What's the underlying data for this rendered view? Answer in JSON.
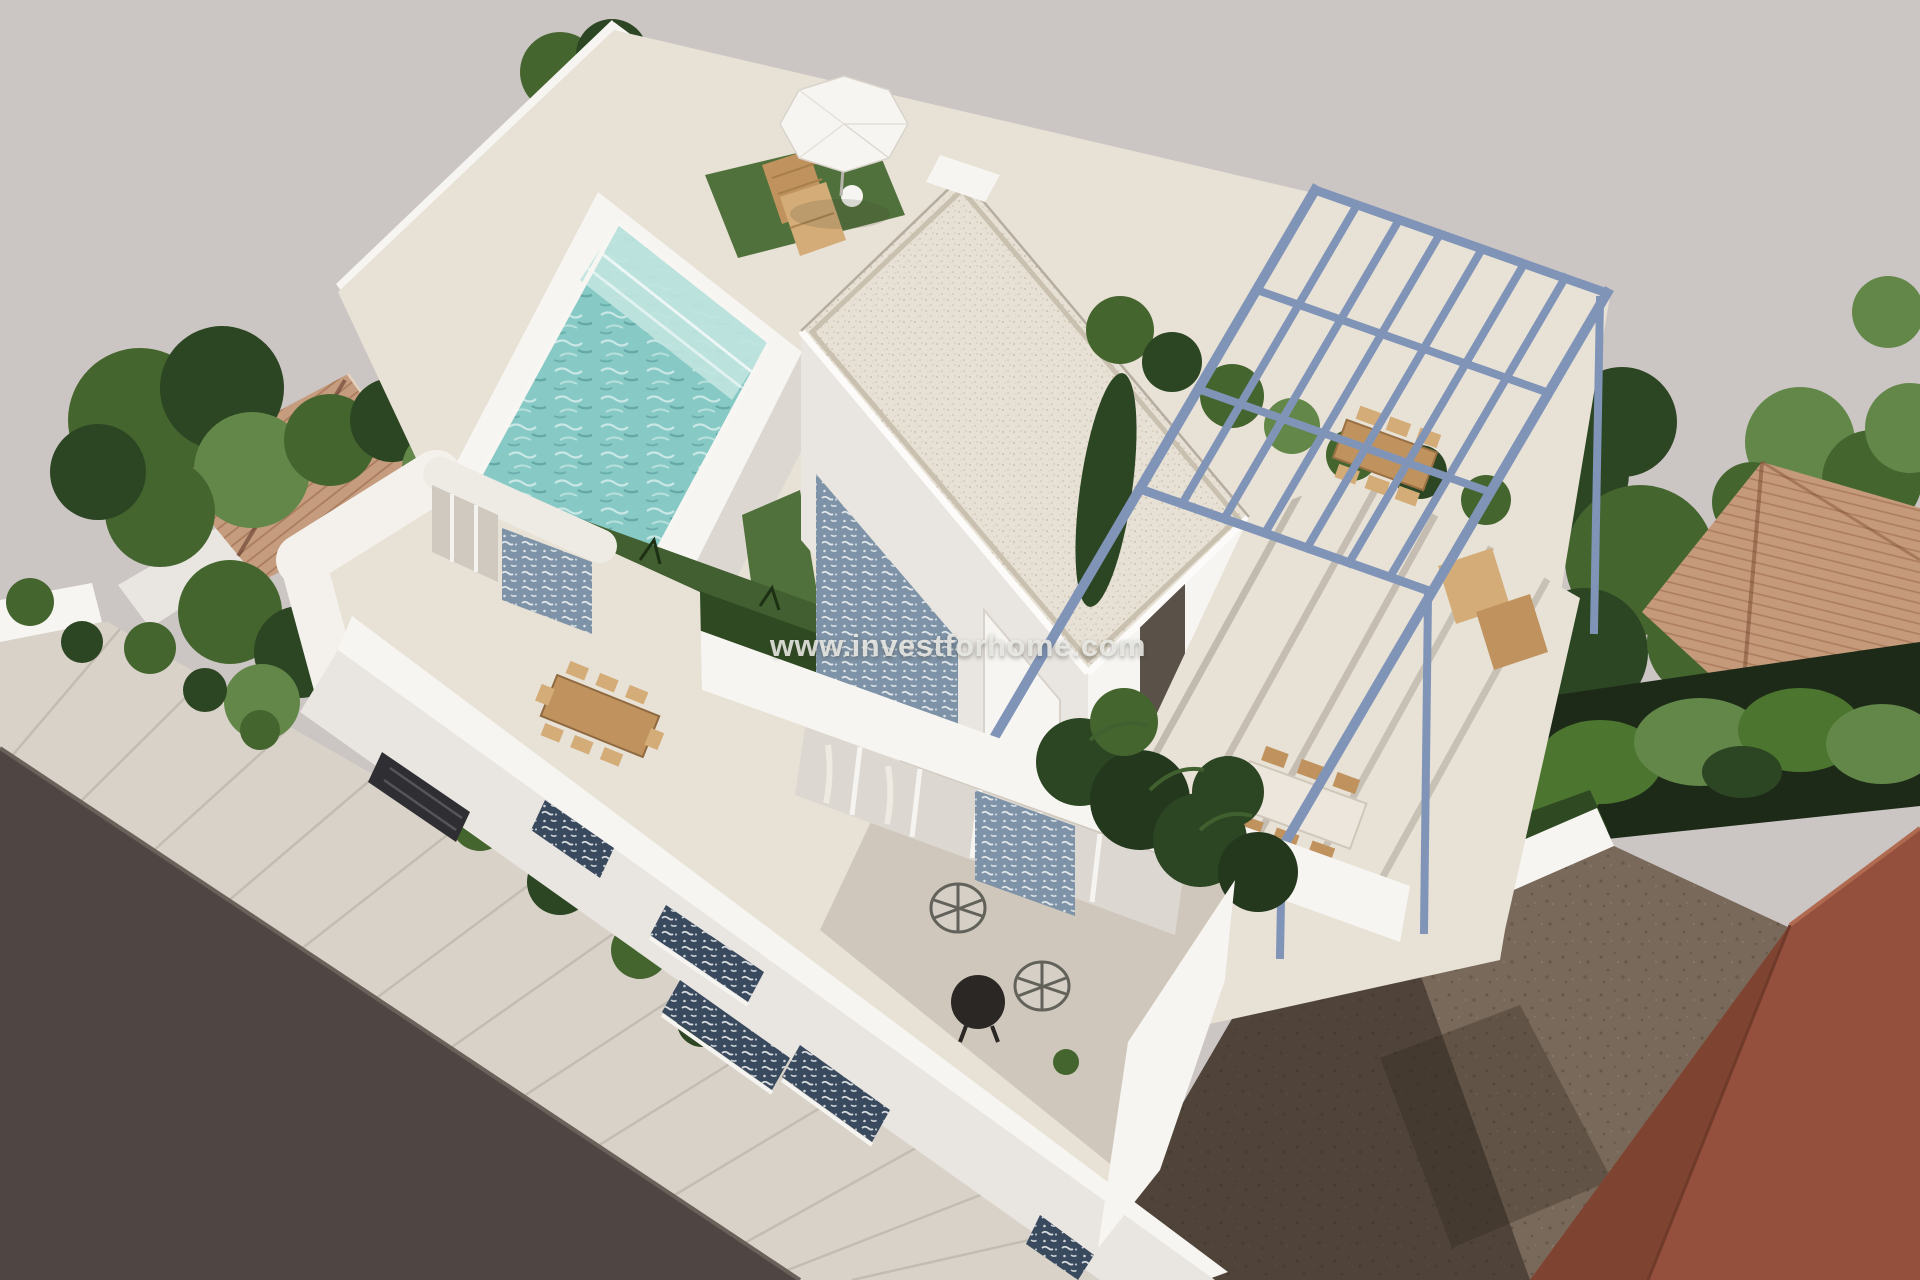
{
  "watermark": {
    "text": "www.investforhome.com"
  },
  "palette": {
    "background": "#cbc5c4",
    "road": "#4f4643",
    "road_edge": "#6a615b",
    "sidewalk": "#d9d2c9",
    "white_bright": "#f7f5f1",
    "white_face": "#e9e5e0",
    "white_shade": "#dcd7d1",
    "cream_floor": "#e8e1d6",
    "cream_roof": "#e7e0d4",
    "lawn_dark": "#2f4a22",
    "lawn_mid": "#51713c",
    "lawn_light": "#6b8d4c",
    "tree_green": "#45652f",
    "tree_dark": "#2c4522",
    "tree_light": "#628748",
    "hedge_green": "#4c7530",
    "pool_water": "#87c9c5",
    "pool_steps": "#bfe4de",
    "pergola_blue": "#8094b8",
    "terracotta": "#c59c7e",
    "terracotta_right": "#c49a7a",
    "tile_blue": "#7e93a7",
    "blind_navy": "#3a4a5e",
    "wood": "#c0935e",
    "wood_light": "#d3ac78",
    "dirt": "#79695a",
    "shadow_dark": "#2a231c",
    "red_building": "#94503c",
    "red_building_dark": "#7f4331",
    "watermark_color": "#e9e8e4"
  },
  "scene": {
    "type": "3d-architectural-aerial-render",
    "elements": [
      {
        "name": "villa",
        "label": "Modern white two-storey villa seen from above"
      },
      {
        "name": "rooftop-pool",
        "label": "Raised rooftop plunge pool with turquoise water"
      },
      {
        "name": "parasol",
        "label": "White parasol with two wooden sun loungers on roof lawn"
      },
      {
        "name": "penthouse",
        "label": "Rooftop room with speckled cream flat roof and blue tiled accent wall"
      },
      {
        "name": "pergola",
        "label": "Blue-grey steel pergola frame over roof dining terrace"
      },
      {
        "name": "roof-dining",
        "label": "Wooden outdoor dining sets under pergola"
      },
      {
        "name": "second-floor-terrace",
        "label": "Front terrace with dining table, round wire chairs and black table"
      },
      {
        "name": "street-facade",
        "label": "Street facade with navy patterned window blinds"
      },
      {
        "name": "road",
        "label": "Dark asphalt road at lower left"
      },
      {
        "name": "sidewalk",
        "label": "Light paved sidewalk strip"
      },
      {
        "name": "dirt-lot",
        "label": "Vacant brown dirt plot at lower right"
      },
      {
        "name": "red-building",
        "label": "Adjacent reddish-brown building at far right"
      },
      {
        "name": "neighbor-roofs",
        "label": "Terracotta tiled roofs of neighbouring houses"
      },
      {
        "name": "trees",
        "label": "Green trees and hedges around the plot"
      }
    ]
  }
}
